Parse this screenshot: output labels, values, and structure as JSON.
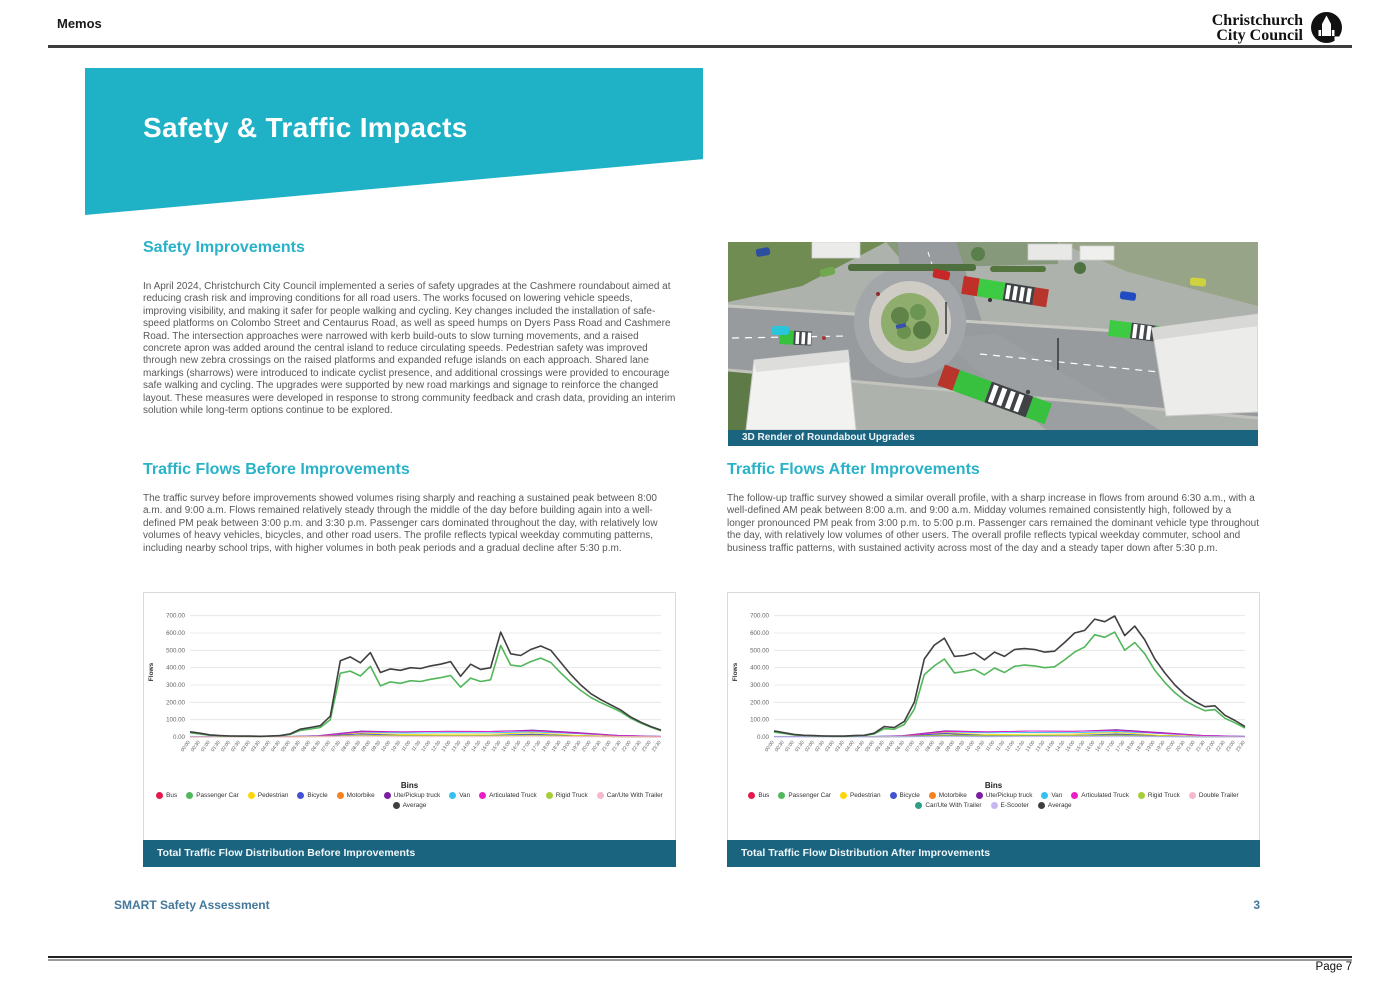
{
  "header": {
    "title": "Memos",
    "logo_line1": "Christchurch",
    "logo_line2": "City Council"
  },
  "banner": {
    "title": "Safety & Traffic Impacts"
  },
  "colors": {
    "banner_teal": "#1fb1c6",
    "heading_teal": "#29b2c8",
    "caption_bar": "#1a6480",
    "footer_blue": "#44789c",
    "body_text": "#58595b"
  },
  "sections": {
    "safety": {
      "heading": "Safety Improvements",
      "body": "In April 2024, Christchurch City Council implemented a series of safety upgrades at the Cashmere roundabout aimed at reducing crash risk and improving conditions for all road users. The works focused on lowering vehicle speeds, improving visibility, and making it safer for people walking and cycling. Key changes included the installation of safe-speed platforms on Colombo Street and Centaurus Road, as well as speed humps on Dyers Pass Road and Cashmere Road. The intersection approaches were narrowed with kerb build-outs to slow turning movements, and a raised concrete apron was added around the central island to reduce circulating speeds. Pedestrian safety was improved through new zebra crossings on the raised platforms and expanded refuge islands on each approach. Shared lane markings (sharrows) were introduced to indicate cyclist presence, and additional crossings were provided to encourage safe walking and cycling. The upgrades were supported by new road markings and signage to reinforce the changed layout. These measures were developed in response to strong community feedback and crash data, providing an interim solution while long-term options continue to be explored."
    },
    "before": {
      "heading": "Traffic Flows Before Improvements",
      "body": "The traffic survey before improvements showed volumes rising sharply and reaching a sustained peak between 8:00 a.m. and 9:00 a.m. Flows remained relatively steady through the middle of the day before building again into a well-defined PM peak between 3:00 p.m. and 3:30 p.m. Passenger cars dominated throughout the day, with relatively low volumes of heavy vehicles, bicycles, and other road users. The profile reflects typical weekday commuting patterns, including nearby school trips, with higher volumes in both peak periods and a gradual decline after 5:30 p.m."
    },
    "after": {
      "heading": "Traffic Flows After Improvements",
      "body": "The follow-up traffic survey showed a similar overall profile, with a sharp increase in flows from around 6:30 a.m., with a well-defined AM peak between 8:00 a.m. and 9:00 a.m. Midday volumes remained consistently high, followed by a longer pronounced PM peak from 3:00 p.m. to 5:00 p.m. Passenger cars remained the dominant vehicle type throughout the day, with relatively low volumes of other users. The overall profile reflects typical weekday commuter, school and business traffic patterns, with sustained activity across most of the day and a steady taper down after 5:30 p.m."
    }
  },
  "figure": {
    "caption": "3D Render of Roundabout Upgrades"
  },
  "footer": {
    "doc_title": "SMART Safety Assessment",
    "page_number": "3",
    "print_label": "Page 7"
  },
  "chart_data": [
    {
      "type": "line",
      "title": "Total Traffic Flow Distribution Before Improvements",
      "xlabel": "",
      "ylabel": "Flows",
      "legend_title": "Bins",
      "legend_position": "bottom",
      "grid": true,
      "ylim": [
        0,
        750
      ],
      "yticks": [
        0,
        100,
        200,
        300,
        400,
        500,
        600,
        700
      ],
      "x": [
        "00:00",
        "00:30",
        "01:00",
        "01:30",
        "02:00",
        "02:30",
        "03:00",
        "03:30",
        "04:00",
        "04:30",
        "05:00",
        "05:30",
        "06:00",
        "06:30",
        "07:00",
        "07:30",
        "08:00",
        "08:30",
        "09:00",
        "09:30",
        "10:00",
        "10:30",
        "11:00",
        "11:30",
        "12:00",
        "12:30",
        "13:00",
        "13:30",
        "14:00",
        "14:30",
        "15:00",
        "15:30",
        "16:00",
        "16:30",
        "17:00",
        "17:30",
        "18:00",
        "18:30",
        "19:00",
        "19:30",
        "20:00",
        "20:30",
        "21:00",
        "21:30",
        "22:00",
        "22:30",
        "23:00",
        "23:30"
      ],
      "series": [
        {
          "name": "Bus",
          "color": "#e51a4c",
          "values": [
            2,
            1,
            1,
            5,
            10,
            9,
            9,
            9,
            11,
            8,
            4,
            2
          ]
        },
        {
          "name": "Passenger Car",
          "color": "#52b65a",
          "emphasis": true,
          "values": [
            25,
            18,
            10,
            6,
            5,
            4,
            4,
            3,
            5,
            7,
            15,
            38,
            46,
            55,
            100,
            368,
            380,
            352,
            408,
            295,
            318,
            310,
            325,
            320,
            333,
            342,
            355,
            288,
            340,
            320,
            330,
            528,
            415,
            408,
            435,
            455,
            430,
            370,
            315,
            268,
            228,
            198,
            172,
            145,
            108,
            80,
            56,
            36
          ]
        },
        {
          "name": "Pedestrian",
          "color": "#ffd60a",
          "values": [
            1,
            1,
            1,
            6,
            22,
            14,
            16,
            16,
            24,
            10,
            4,
            2
          ]
        },
        {
          "name": "Bicycle",
          "color": "#4153d0",
          "values": [
            1,
            0,
            0,
            5,
            18,
            8,
            8,
            9,
            16,
            6,
            2,
            1
          ]
        },
        {
          "name": "Motorbike",
          "color": "#f58220",
          "values": [
            1,
            0,
            0,
            3,
            8,
            5,
            6,
            5,
            8,
            4,
            2,
            1
          ]
        },
        {
          "name": "Ute/Pickup truck",
          "color": "#7a1fa2",
          "values": [
            3,
            1,
            1,
            8,
            34,
            30,
            33,
            32,
            40,
            26,
            10,
            4
          ]
        },
        {
          "name": "Van",
          "color": "#33c1f0",
          "values": [
            4,
            2,
            2,
            7,
            28,
            23,
            25,
            24,
            30,
            20,
            8,
            4
          ]
        },
        {
          "name": "Articulated Truck",
          "color": "#e81ec8",
          "values": [
            2,
            1,
            1,
            6,
            30,
            30,
            33,
            32,
            36,
            22,
            8,
            3
          ]
        },
        {
          "name": "Rigid Truck",
          "color": "#a6ce39",
          "values": [
            1,
            0,
            1,
            4,
            10,
            8,
            9,
            8,
            10,
            6,
            3,
            1
          ]
        },
        {
          "name": "Car/Ute With Trailer",
          "color": "#f4b8cf",
          "values": [
            1,
            0,
            0,
            2,
            5,
            4,
            4,
            4,
            5,
            3,
            1,
            1
          ]
        },
        {
          "name": "Average",
          "color": "#3f3f3f",
          "emphasis": true,
          "values": [
            30,
            22,
            12,
            8,
            6,
            5,
            5,
            4,
            6,
            8,
            18,
            45,
            55,
            65,
            120,
            440,
            462,
            428,
            487,
            372,
            393,
            385,
            400,
            395,
            410,
            420,
            435,
            350,
            420,
            390,
            400,
            605,
            480,
            470,
            505,
            525,
            500,
            430,
            360,
            300,
            250,
            215,
            185,
            155,
            115,
            85,
            60,
            40
          ]
        }
      ]
    },
    {
      "type": "line",
      "title": "Total Traffic Flow Distribution After Improvements",
      "xlabel": "",
      "ylabel": "Flows",
      "legend_title": "Bins",
      "legend_position": "bottom",
      "grid": true,
      "ylim": [
        0,
        750
      ],
      "yticks": [
        0,
        100,
        200,
        300,
        400,
        500,
        600,
        700
      ],
      "x": [
        "00:00",
        "00:30",
        "01:00",
        "01:30",
        "02:00",
        "02:30",
        "03:00",
        "03:30",
        "04:00",
        "04:30",
        "05:00",
        "05:30",
        "06:00",
        "06:30",
        "07:00",
        "07:30",
        "08:00",
        "08:30",
        "09:00",
        "09:30",
        "10:00",
        "10:30",
        "11:00",
        "11:30",
        "12:00",
        "12:30",
        "13:00",
        "13:30",
        "14:00",
        "14:30",
        "15:00",
        "15:30",
        "16:00",
        "16:30",
        "17:00",
        "17:30",
        "18:00",
        "18:30",
        "19:00",
        "19:30",
        "20:00",
        "20:30",
        "21:00",
        "21:30",
        "22:00",
        "22:30",
        "23:00",
        "23:30"
      ],
      "series": [
        {
          "name": "Bus",
          "color": "#e51a4c",
          "values": [
            2,
            1,
            1,
            5,
            11,
            9,
            9,
            10,
            12,
            8,
            4,
            2
          ]
        },
        {
          "name": "Passenger Car",
          "color": "#52b65a",
          "emphasis": true,
          "values": [
            28,
            20,
            12,
            8,
            6,
            5,
            4,
            4,
            6,
            8,
            18,
            48,
            45,
            72,
            160,
            360,
            410,
            450,
            370,
            378,
            390,
            358,
            398,
            372,
            408,
            415,
            410,
            400,
            405,
            445,
            490,
            520,
            590,
            575,
            605,
            500,
            545,
            480,
            385,
            315,
            255,
            210,
            178,
            152,
            158,
            108,
            82,
            52
          ]
        },
        {
          "name": "Pedestrian",
          "color": "#ffd60a",
          "values": [
            1,
            1,
            1,
            6,
            24,
            14,
            16,
            17,
            26,
            10,
            4,
            2
          ]
        },
        {
          "name": "Bicycle",
          "color": "#4153d0",
          "values": [
            1,
            0,
            0,
            5,
            20,
            8,
            9,
            9,
            18,
            6,
            2,
            1
          ]
        },
        {
          "name": "Motorbike",
          "color": "#f58220",
          "values": [
            1,
            0,
            0,
            3,
            9,
            5,
            6,
            6,
            9,
            4,
            2,
            1
          ]
        },
        {
          "name": "Ute/Pickup truck",
          "color": "#7a1fa2",
          "values": [
            3,
            1,
            1,
            8,
            36,
            30,
            34,
            33,
            42,
            26,
            10,
            4
          ]
        },
        {
          "name": "Van",
          "color": "#33c1f0",
          "values": [
            4,
            2,
            2,
            7,
            30,
            24,
            26,
            25,
            32,
            20,
            8,
            4
          ]
        },
        {
          "name": "Articulated Truck",
          "color": "#e81ec8",
          "values": [
            2,
            1,
            1,
            6,
            32,
            30,
            34,
            33,
            38,
            22,
            8,
            3
          ]
        },
        {
          "name": "Rigid Truck",
          "color": "#a6ce39",
          "values": [
            1,
            0,
            1,
            4,
            11,
            8,
            9,
            9,
            11,
            6,
            3,
            1
          ]
        },
        {
          "name": "Double Trailer",
          "color": "#f4b8cf",
          "values": [
            1,
            0,
            0,
            2,
            4,
            4,
            4,
            4,
            5,
            3,
            1,
            0
          ]
        },
        {
          "name": "Car/Ute With Trailer",
          "color": "#2f9e85",
          "values": [
            1,
            0,
            0,
            2,
            5,
            4,
            5,
            4,
            5,
            3,
            1,
            1
          ]
        },
        {
          "name": "E-Scooter",
          "color": "#c8b6f4",
          "values": [
            0,
            0,
            0,
            1,
            3,
            2,
            3,
            3,
            4,
            2,
            1,
            0
          ]
        },
        {
          "name": "Average",
          "color": "#3f3f3f",
          "emphasis": true,
          "values": [
            35,
            25,
            15,
            10,
            8,
            6,
            5,
            5,
            8,
            10,
            22,
            60,
            55,
            90,
            200,
            450,
            530,
            570,
            465,
            470,
            485,
            445,
            490,
            465,
            505,
            510,
            505,
            490,
            495,
            545,
            600,
            615,
            680,
            665,
            698,
            585,
            640,
            560,
            450,
            370,
            300,
            245,
            205,
            175,
            180,
            125,
            95,
            60
          ]
        }
      ]
    }
  ]
}
